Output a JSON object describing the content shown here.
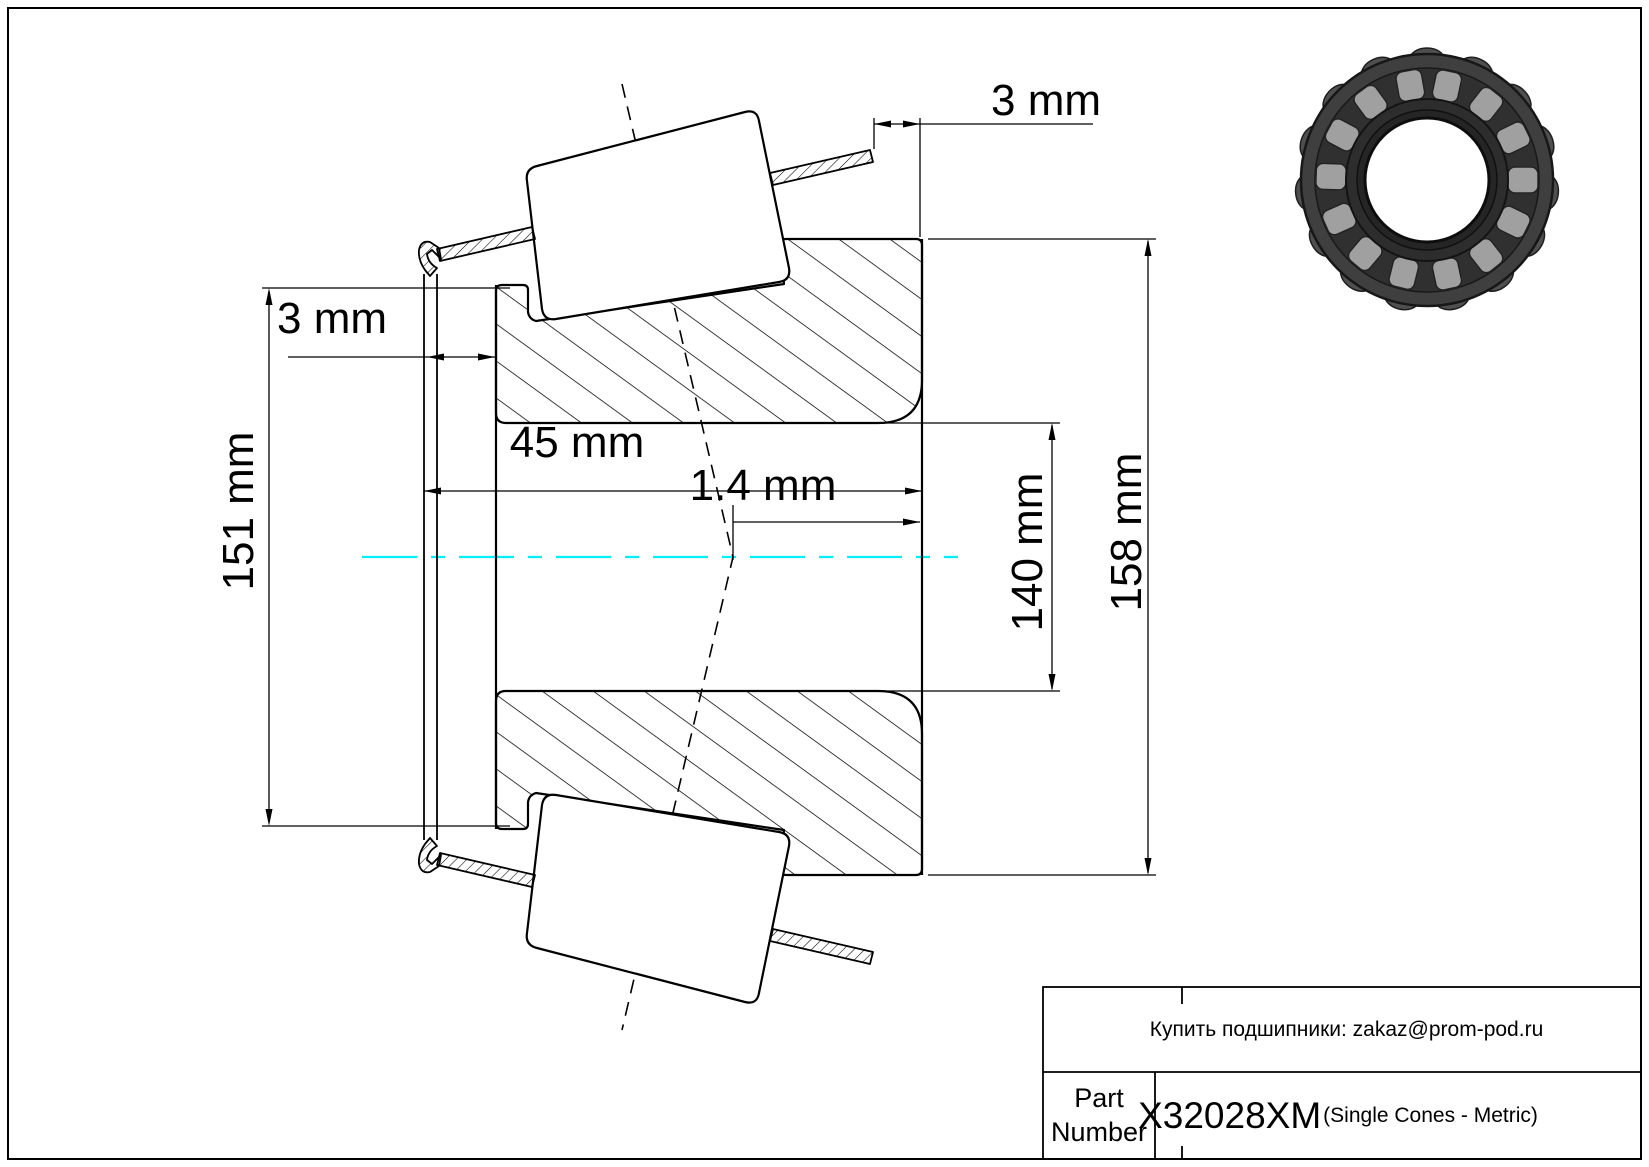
{
  "drawing_title": "Tapered roller bearing single cone section drawing",
  "dimensions": {
    "cage_protrusion_left": "3 mm",
    "cage_protrusion_right": "3 mm",
    "overall_width": "45 mm",
    "effective_center_offset": "1.4 mm",
    "front_face_diameter": "151 mm",
    "bore_diameter": "140 mm",
    "outer_diameter": "158 mm"
  },
  "title_block": {
    "contact_note": "Купить подшипники: zakaz@prom-pod.ru",
    "part_label": "Part Number",
    "part_number": "X32028XM",
    "part_type": "(Single Cones - Metric)"
  },
  "colors": {
    "centerline": "#00f0ff",
    "line": "#000000",
    "bearing_outer": "#3f3f3f",
    "bearing_roller": "#a0a0a0",
    "bearing_inner": "#2d2d2d"
  }
}
